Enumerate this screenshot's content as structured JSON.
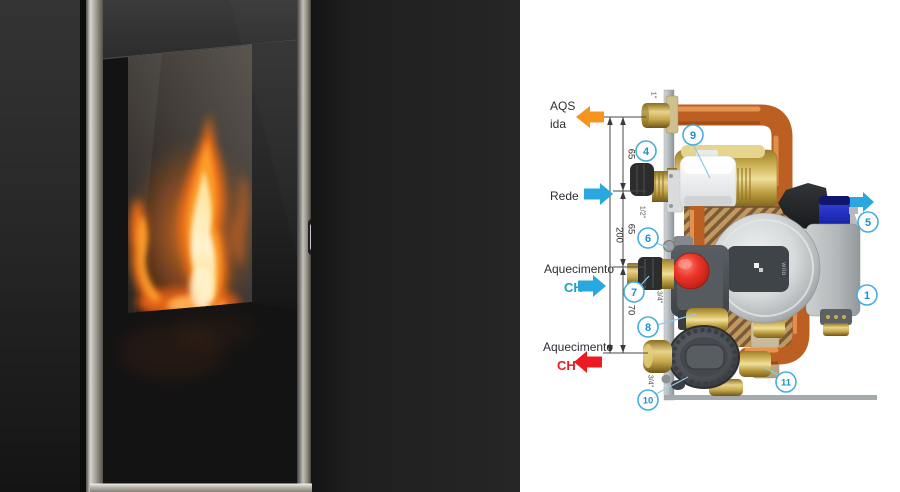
{
  "diagram": {
    "connections": {
      "aqs": {
        "line1": "AQS",
        "line2": "ida",
        "direction": "left",
        "arrow_color": "#F7941D",
        "pipe_size": "1\""
      },
      "rede": {
        "label": "Rede",
        "direction": "right",
        "arrow_color": "#29A8E0",
        "pipe_size": "1/2\""
      },
      "ch_flow": {
        "label": "Aquecimento",
        "ch": "CH",
        "ch_color": "#1E9CD7",
        "direction": "right",
        "arrow_color": "#29A8E0",
        "pipe_size": "3/4\""
      },
      "ch_return": {
        "label": "Aquecimento",
        "ch": "CH",
        "ch_color": "#EC1B23",
        "direction": "left",
        "arrow_color": "#EC1B23",
        "pipe_size": "3/4\""
      }
    },
    "vent_arrow_color": "#29A8E0",
    "dimensions": {
      "total": "200",
      "segment_top": "65",
      "segment_middle": "65",
      "segment_bottom": "70"
    },
    "parts": {
      "p1": "1",
      "p4": "4",
      "p5": "5",
      "p6": "6",
      "p7": "7",
      "p8": "8",
      "p9": "9",
      "p10": "10",
      "p11": "11"
    },
    "pump_brand": "wilo",
    "part_circle_stroke": "#46AEDE",
    "part_number_color": "#1F8FCC"
  }
}
